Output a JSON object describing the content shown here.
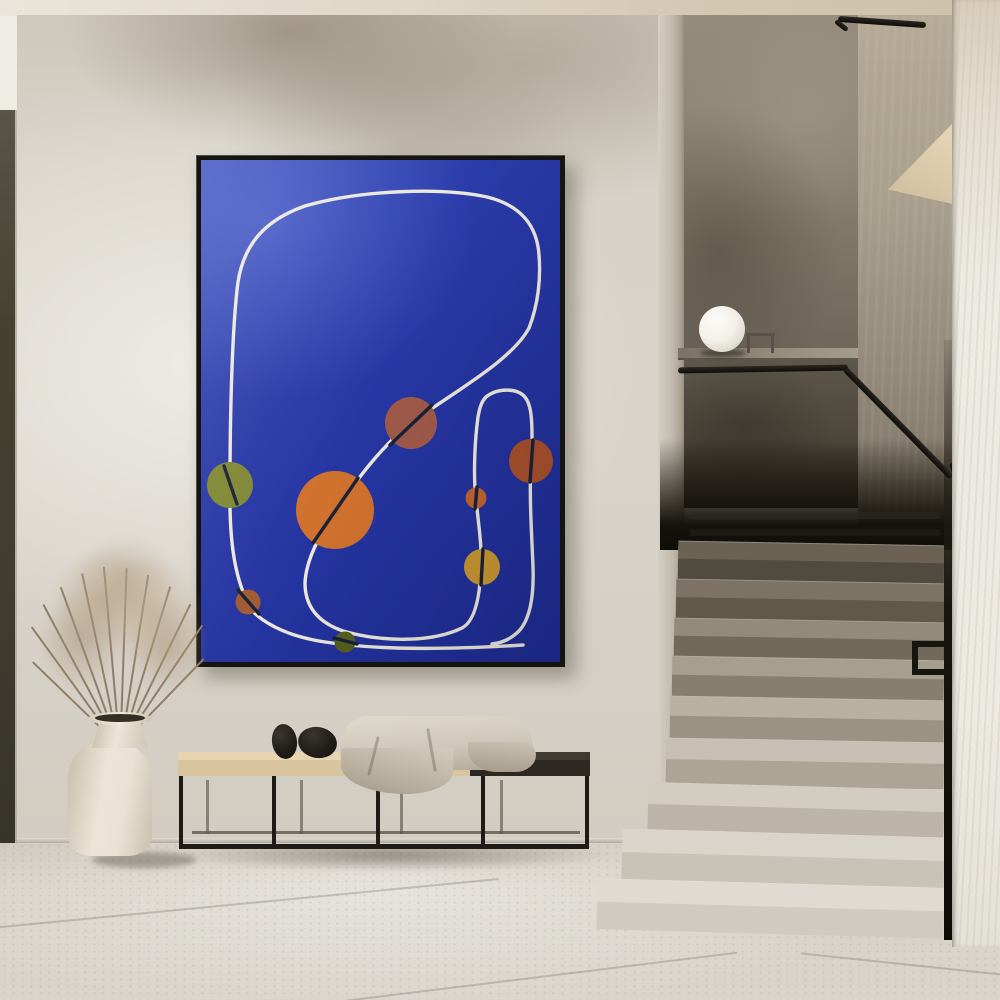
{
  "palette": {
    "wall": "#d9d4cb",
    "floor": "#d6d1c8",
    "rail": "#17150f",
    "frame": "#16140f",
    "poster-top": "#3448b8",
    "poster-mid": "#2737a5",
    "poster-bot": "#1e2c90",
    "bench-wood": "#d8c49d",
    "bench-dark": "#2e2822",
    "metal": "#1f1c18",
    "pebble": "#211e1a",
    "blanket": "#cfc8ba",
    "vase": "#e9e2d4",
    "plant": "#8f7e66",
    "lamp": "#f7f5f0"
  },
  "poster": {
    "background": "#2737a5",
    "line_color": "#ece8dd",
    "dark_line": "#1b2136",
    "line_paths": [
      "M46,441 C34,416 28,382 29,325 C29,256 31,168 37,122 C43,84 64,60 104,46 C160,30 240,27 286,37 C319,45 336,65 338,95 C340,119 337,145 328,168 C311,200 256,230 210,263 C181,286 157,318 135,350 C118,376 105,400 104,423 C104,446 116,462 142,471 C180,482 230,483 261,468 C274,461 279,437 280,407 C281,383 277,362 275,338 C272,316 274,278 277,257 C279,246 281,241 285,237 C296,228 315,228 323,236 C330,243 331,258 331,277 C332,290 331,296 330,303 C328,338 331,378 332,407 C333,436 329,459 318,471 C310,479 300,483 291,484",
      "M46,444 C57,461 84,476 124,482 C182,491 256,489 322,485"
    ],
    "circles": [
      {
        "name": "olive-circle",
        "cx": 29,
        "cy": 325,
        "r": 23,
        "fill": "#7f8833",
        "seg": "M23,306 L36,344"
      },
      {
        "name": "large-orange-circle",
        "cx": 134,
        "cy": 350,
        "r": 39,
        "fill": "#d0712e",
        "seg": "M157,318 L112,383"
      },
      {
        "name": "mauve-circle",
        "cx": 210,
        "cy": 263,
        "r": 26,
        "fill": "#9f5a49",
        "seg": "M231,245 L189,285"
      },
      {
        "name": "rust-circle",
        "cx": 330,
        "cy": 301,
        "r": 22,
        "fill": "#a8512b",
        "seg": "M332,280 L329,322"
      },
      {
        "name": "small-orange-circle",
        "cx": 275,
        "cy": 338,
        "r": 10.5,
        "fill": "#bf652f",
        "seg": "M276,327 L274,349"
      },
      {
        "name": "mustard-circle",
        "cx": 281,
        "cy": 407,
        "r": 18,
        "fill": "#c8982f",
        "seg": "M282,389 L280,425"
      },
      {
        "name": "sienna-circle",
        "cx": 47,
        "cy": 442,
        "r": 12.5,
        "fill": "#a05c33",
        "seg": "M37,430 L58,454"
      },
      {
        "name": "dark-olive-circle",
        "cx": 144,
        "cy": 482,
        "r": 10.5,
        "fill": "#55601f",
        "seg": "M133,478 L156,484"
      }
    ]
  },
  "steps": [
    {
      "top": 543,
      "h": 38,
      "left": 678,
      "tread": "#6b6254",
      "riser": "#514a3f"
    },
    {
      "top": 581,
      "h": 39,
      "left": 676,
      "tread": "#7d7364",
      "riser": "#615849"
    },
    {
      "top": 620,
      "h": 38,
      "left": 674,
      "tread": "#948a7a",
      "riser": "#73695a"
    },
    {
      "top": 658,
      "h": 40,
      "left": 672,
      "tread": "#a89e8f",
      "riser": "#887e6f"
    },
    {
      "top": 698,
      "h": 42,
      "left": 670,
      "tread": "#b9b0a2",
      "riser": "#9b9284"
    },
    {
      "top": 740,
      "h": 46,
      "left": 666,
      "tread": "#c7bfb3",
      "riser": "#ada496"
    },
    {
      "top": 786,
      "h": 47,
      "left": 648,
      "tread": "#d2ccc1",
      "riser": "#bcb4a8"
    },
    {
      "top": 833,
      "h": 50,
      "left": 622,
      "tread": "#dad5cb",
      "riser": "#c8c2b7"
    },
    {
      "top": 883,
      "h": 50,
      "left": 597,
      "tread": "#dfdbd2",
      "riser": "#d0cbc1"
    }
  ],
  "stems": [
    {
      "x": 104,
      "h": 125,
      "rot": -36
    },
    {
      "x": 108,
      "h": 140,
      "rot": -28
    },
    {
      "x": 111,
      "h": 150,
      "rot": -20
    },
    {
      "x": 114,
      "h": 158,
      "rot": -12
    },
    {
      "x": 117,
      "h": 162,
      "rot": -5
    },
    {
      "x": 120,
      "h": 160,
      "rot": 2
    },
    {
      "x": 123,
      "h": 155,
      "rot": 9
    },
    {
      "x": 126,
      "h": 148,
      "rot": 17
    },
    {
      "x": 129,
      "h": 138,
      "rot": 26
    },
    {
      "x": 132,
      "h": 124,
      "rot": 34
    },
    {
      "x": 100,
      "h": 95,
      "rot": -46
    },
    {
      "x": 136,
      "h": 96,
      "rot": 44
    }
  ]
}
